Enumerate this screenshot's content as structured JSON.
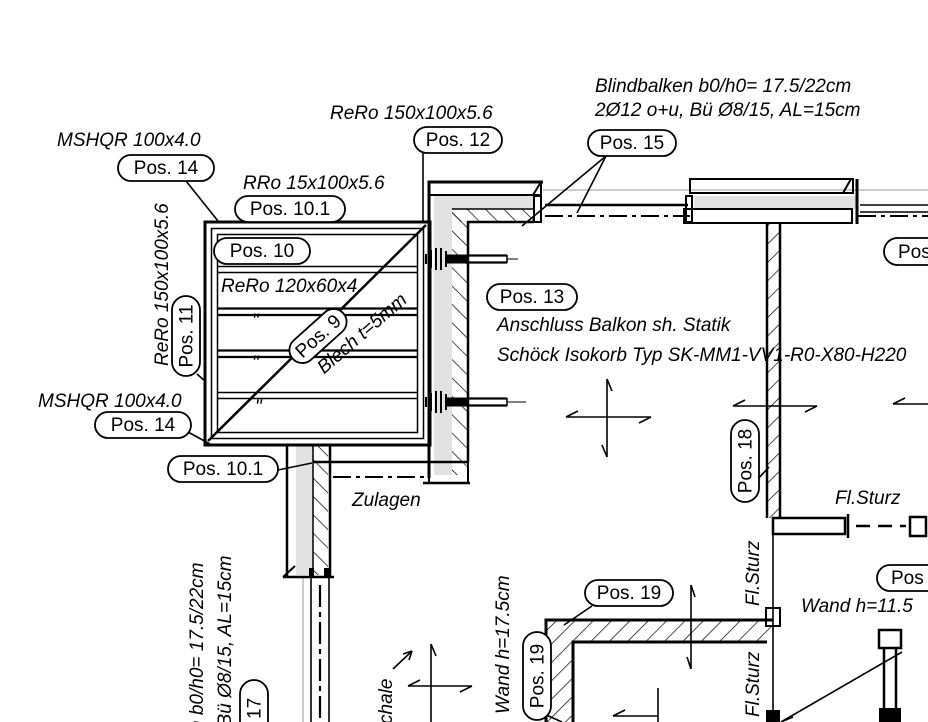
{
  "annotations": {
    "blindbalken_line1": "Blindbalken b0/h0= 17.5/22cm",
    "blindbalken_line2": "2Ø12 o+u, Bü Ø8/15, AL=15cm",
    "mshqr_top": "MSHQR 100x4.0",
    "rero_top": "ReRo 150x100x5.6",
    "rro": "RRo 15x100x5.6",
    "rero_left_rotated": "ReRo 150x100x5.6",
    "rero_120": "ReRo 120x60x4",
    "ditto_mark": "\"",
    "blech": "Blech t=5mm",
    "mshqr_bottom": "MSHQR 100x4.0",
    "anschluss": "Anschluss Balkon sh. Statik",
    "schoeck": "Schöck Isokorb Typ SK-MM1-VV1-R0-X80-H220",
    "zulagen": "Zulagen",
    "fl_sturz": "Fl.Sturz",
    "fl_sturz_rot1": "Fl.Sturz",
    "fl_sturz_rot2": "Fl.Sturz",
    "wand_h_175": "Wand h=17.5cm",
    "wand_h_115": "Wand h=11.5",
    "blind_rot_line1": "n b0/h0= 17.5/22cm",
    "blind_rot_line2": ", Bü Ø8/15, AL=15cm",
    "schale_fragment": "chale"
  },
  "pos_labels": {
    "pos14_top": "Pos. 14",
    "pos12": "Pos. 12",
    "pos15": "Pos. 15",
    "pos101_top": "Pos. 10.1",
    "pos10": "Pos. 10",
    "pos11": "Pos. 11",
    "pos9": "Pos. 9",
    "pos14_bottom": "Pos. 14",
    "pos101_bottom": "Pos. 10.1",
    "pos13": "Pos. 13",
    "pos18": "Pos. 18",
    "pos19_top": "Pos. 19",
    "pos19_side": "Pos. 19",
    "pos17_fragment": "17",
    "pos_cut_right_top": "Pos",
    "pos_cut_right_bottom": "Pos"
  },
  "colors": {
    "line": "#000000",
    "grey_fill": "#e2e2e2",
    "faint_line": "#9a9a9a",
    "background": "#ffffff"
  }
}
